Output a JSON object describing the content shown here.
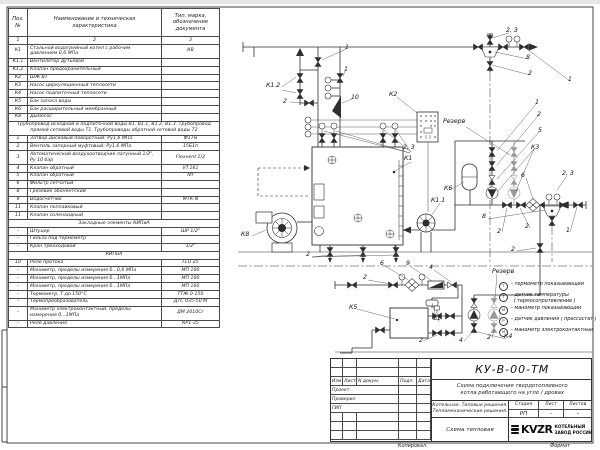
{
  "sheet": {
    "doc_number": "КУ-В-00-ТМ",
    "scheme_description": "Схема подключения твердотопливного\nкотла работающего на угле / дровах",
    "project_name": "Котельная. Типовые решения.\nТепломеханические решения.",
    "stage_label": "Стадия",
    "sheet_label": "Лист",
    "sheets_label": "Листов",
    "stage_value": "РП",
    "sheet_value": "-",
    "sheets_value": "-",
    "drawing_type": "Схема тепловая",
    "logo_text": "KVZR",
    "company_line1": "КОТЕЛЬНЫЙ",
    "company_line2": "ЗАВОД РОССИИ",
    "copied_label": "Копировал.",
    "format_label": "Формат",
    "revision_header": [
      "Изм",
      "Лист",
      "N докум.",
      "Подп.",
      "Дата"
    ],
    "roles": [
      "Проект.",
      "Проверил",
      "ГИП"
    ]
  },
  "spec_table": {
    "headers": {
      "pos": "Поз.\n№",
      "name": "Наименование и техническая\nхарактеристика",
      "type": "Тип, марка,\nобозначение\nдокумента"
    },
    "rows": [
      {
        "pos": "1",
        "name": "2",
        "type": "3",
        "center": true
      },
      {
        "pos": "К1",
        "name": "Стальной водогрейный котел с рабочим давлением 0,6 МПа",
        "type": "КВ"
      },
      {
        "pos": "К1.1",
        "name": "Вентилятор дутьевой",
        "type": ""
      },
      {
        "pos": "К1.2",
        "name": "Клапан предохранительный",
        "type": ""
      },
      {
        "pos": "К2",
        "name": "ШЖ ВТ",
        "type": ""
      },
      {
        "pos": "К3",
        "name": "Насос циркуляционный теплосети",
        "type": ""
      },
      {
        "pos": "К4",
        "name": "Насос подпиточный теплосети",
        "type": ""
      },
      {
        "pos": "К5",
        "name": "Бак запаса воды",
        "type": ""
      },
      {
        "pos": "К6",
        "name": "Бак расширительный мембранный",
        "type": ""
      },
      {
        "pos": "К8",
        "name": "Дымосос",
        "type": ""
      },
      {
        "section": "Трубопровод исходной и подпиточной воды В1, В1.1, В1.2, В1.3. Трубопровод прямой сетевой воды Т1. Трубопроводы обратной сетевой воды Т2"
      },
      {
        "pos": "1",
        "name": "Затвор дисковый поворотный: Ру1,6 МПа",
        "type": "Ф17м"
      },
      {
        "pos": "2",
        "name": "Вентиль запорный муфтовый: Ру1,6 МПа",
        "type": "15Б1п"
      },
      {
        "pos": "3",
        "name": "Автоматический воздухоотводчик латунный 1/2\", Ру 10 бар",
        "type": "Flexvent 1/2"
      },
      {
        "pos": "4",
        "name": "Клапан обратный",
        "type": "VT.161"
      },
      {
        "pos": "5",
        "name": "Клапан обратный",
        "type": "NY"
      },
      {
        "pos": "6",
        "name": "Фильтр сетчатый",
        "type": ""
      },
      {
        "pos": "8",
        "name": "Грязевик абонентский",
        "type": ""
      },
      {
        "pos": "9",
        "name": "Водосчетчик",
        "type": "МТК-N"
      },
      {
        "pos": "11",
        "name": "Клапан поплавковый",
        "type": ""
      },
      {
        "pos": "11",
        "name": "Клапан соленоидный",
        "type": ""
      },
      {
        "section": "Закладные элементы КИПиА"
      },
      {
        "pos": "–",
        "name": "Штуцер",
        "type": "ШР 1/2\""
      },
      {
        "pos": "–",
        "name": "Гильза под термометр",
        "type": ""
      },
      {
        "pos": "–",
        "name": "Кран трехходовой",
        "type": "1/2\""
      },
      {
        "section": "КИПиА"
      },
      {
        "pos": "10",
        "name": "Реле протока",
        "type": "FLU 25"
      },
      {
        "pos": "–",
        "name": "Манометр, пределы измерения 0...0,6 МПа",
        "type": "МП 100"
      },
      {
        "pos": "–",
        "name": "Манометр, пределы измерения 0...1МПа",
        "type": "МП 100"
      },
      {
        "pos": "–",
        "name": "Манометр, пределы измерения 0...1МПа",
        "type": "МП 160"
      },
      {
        "pos": "–",
        "name": "Термометр, Т до 150°С",
        "type": "ТТЖ 0-150"
      },
      {
        "pos": "–",
        "name": "Термопреобразователь",
        "type": "ДТС 035-50 М"
      },
      {
        "pos": "–",
        "name": "Манометр электроконтактный, пределы измерения 0...1МПа",
        "type": "ДМ 2010Сг"
      },
      {
        "pos": "–",
        "name": "Реле давления",
        "type": "КР1-35"
      }
    ]
  },
  "diagram": {
    "labels": [
      {
        "t": "1",
        "x": 345,
        "y": 44
      },
      {
        "t": "1",
        "x": 344,
        "y": 66
      },
      {
        "t": "К1.2",
        "x": 266,
        "y": 82
      },
      {
        "t": "2",
        "x": 283,
        "y": 98
      },
      {
        "t": "10",
        "x": 351,
        "y": 94
      },
      {
        "t": "К2",
        "x": 389,
        "y": 91
      },
      {
        "t": "2, 3",
        "x": 506,
        "y": 27
      },
      {
        "t": "8",
        "x": 526,
        "y": 54
      },
      {
        "t": "2",
        "x": 528,
        "y": 70
      },
      {
        "t": "1",
        "x": 568,
        "y": 76
      },
      {
        "t": "Резерв",
        "x": 443,
        "y": 118
      },
      {
        "t": "1",
        "x": 535,
        "y": 99
      },
      {
        "t": "2",
        "x": 537,
        "y": 111
      },
      {
        "t": "5",
        "x": 538,
        "y": 127
      },
      {
        "t": "К3",
        "x": 531,
        "y": 144
      },
      {
        "t": "2, 3",
        "x": 403,
        "y": 144
      },
      {
        "t": "К1",
        "x": 404,
        "y": 155
      },
      {
        "t": "К6",
        "x": 444,
        "y": 185
      },
      {
        "t": "К1.1",
        "x": 431,
        "y": 197
      },
      {
        "t": "6",
        "x": 521,
        "y": 172
      },
      {
        "t": "2, 3",
        "x": 562,
        "y": 170
      },
      {
        "t": "8",
        "x": 482,
        "y": 213
      },
      {
        "t": "2",
        "x": 497,
        "y": 228
      },
      {
        "t": "2",
        "x": 525,
        "y": 223
      },
      {
        "t": "1",
        "x": 566,
        "y": 227
      },
      {
        "t": "К8",
        "x": 241,
        "y": 231
      },
      {
        "t": "2",
        "x": 306,
        "y": 251
      },
      {
        "t": "2",
        "x": 511,
        "y": 246
      },
      {
        "t": "6",
        "x": 380,
        "y": 260
      },
      {
        "t": "9",
        "x": 406,
        "y": 260
      },
      {
        "t": "4",
        "x": 429,
        "y": 264
      },
      {
        "t": "2",
        "x": 363,
        "y": 274
      },
      {
        "t": "Резерв",
        "x": 492,
        "y": 268
      },
      {
        "t": "К5",
        "x": 349,
        "y": 304
      },
      {
        "t": "11",
        "x": 433,
        "y": 315
      },
      {
        "t": "2",
        "x": 419,
        "y": 337
      },
      {
        "t": "4",
        "x": 459,
        "y": 337
      },
      {
        "t": "2",
        "x": 487,
        "y": 334
      },
      {
        "t": "К4",
        "x": 504,
        "y": 333
      }
    ],
    "legend": {
      "items": [
        {
          "symbol": "Т",
          "text": "– термометр показывающий"
        },
        {
          "symbol": "Т",
          "text": "– датчик температуры\n  ( термосопротивление )"
        },
        {
          "symbol": "М",
          "text": "– манометр показывающий"
        },
        {
          "symbol": "Р",
          "text": "– датчик давления ( прессостат )"
        },
        {
          "symbol": "М",
          "text": "– манометр электроконтактный"
        }
      ]
    }
  }
}
